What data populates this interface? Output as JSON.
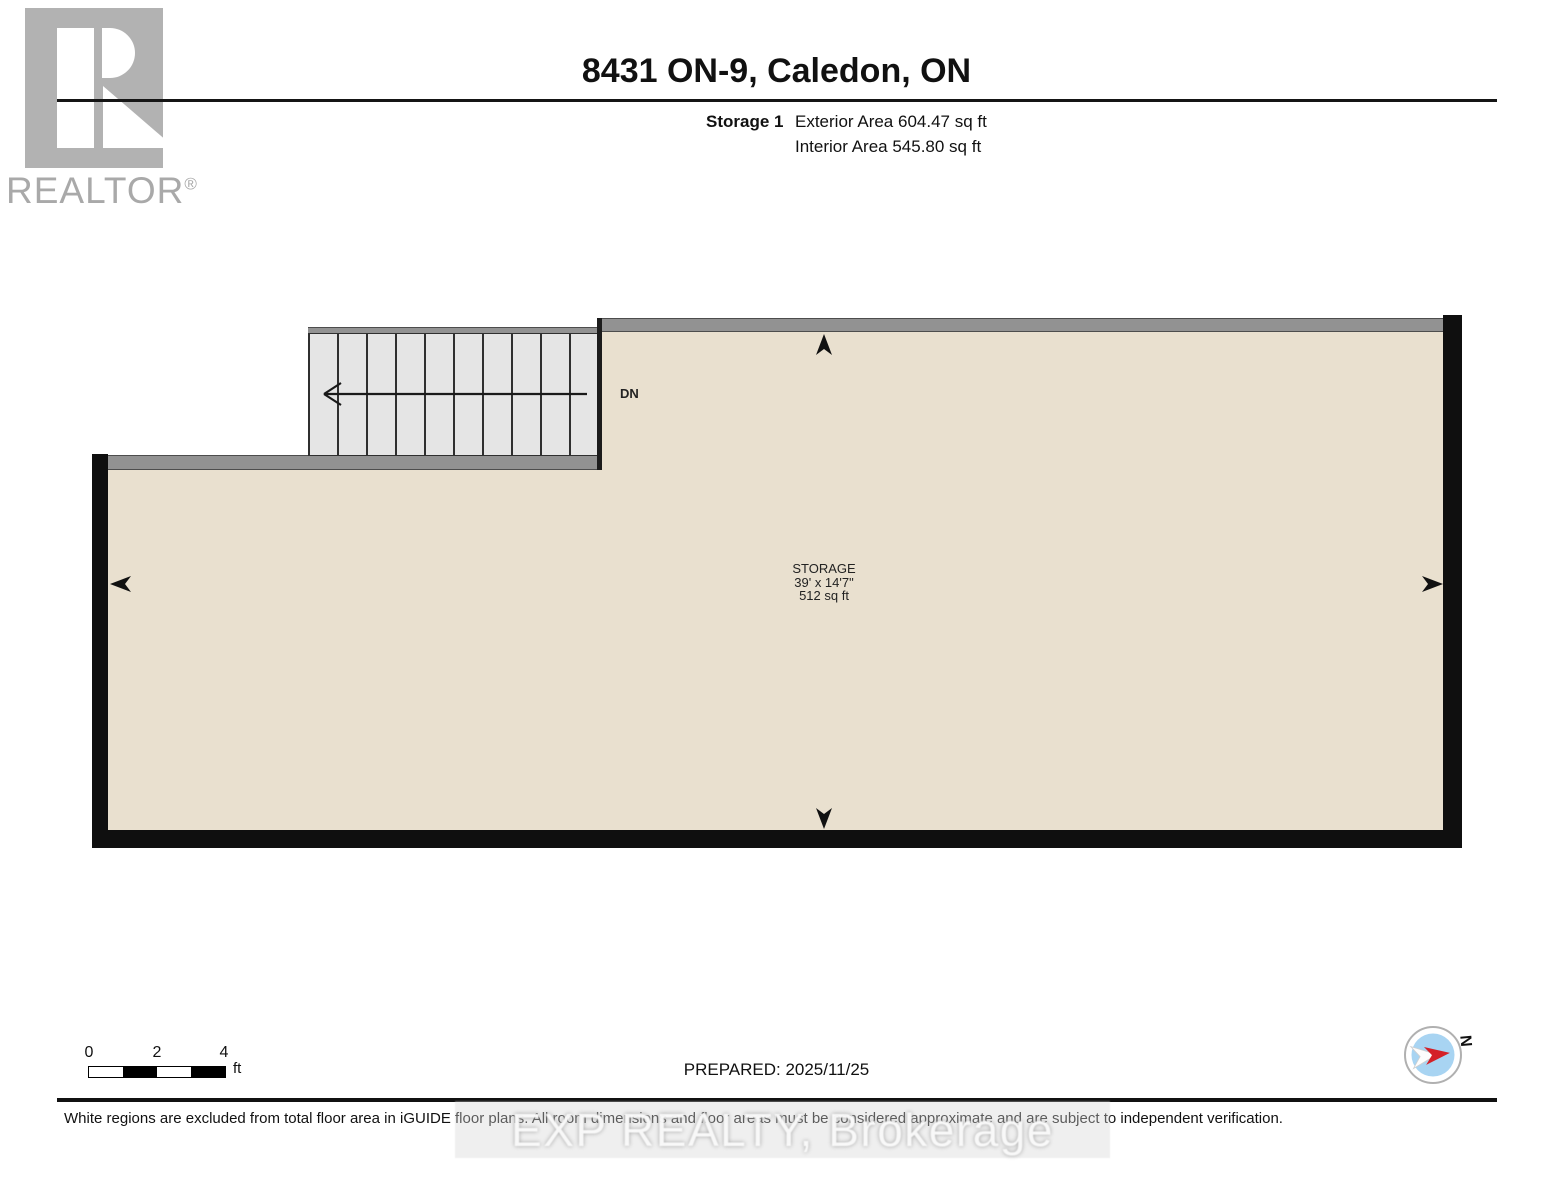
{
  "header": {
    "logo_text": "REALTOR",
    "logo_reg": "®",
    "title": "8431 ON-9, Caledon, ON",
    "floor_label": "Storage 1",
    "exterior_area": "Exterior Area 604.47 sq ft",
    "interior_area": "Interior Area 545.80 sq ft"
  },
  "plan": {
    "room": {
      "name": "STORAGE",
      "dimensions": "39' x 14'7\"",
      "area": "512 sq ft"
    },
    "stairs_label": "DN",
    "colors": {
      "floor_fill": "#e9e0cf",
      "wall_gray": "#929292",
      "wall_black": "#0f0f0f",
      "stair_fill": "#e5e5e5",
      "compass_blue": "#a8d4f2",
      "compass_red": "#d42027",
      "logo_gray": "#b2b2b2"
    }
  },
  "footer": {
    "scale": {
      "ticks": [
        "0",
        "2",
        "4"
      ],
      "unit": "ft"
    },
    "prepared": "PREPARED: 2025/11/25",
    "compass_label": "N",
    "disclaimer": "White regions are excluded from total floor area in iGUIDE floor plans. All room dimensions and floor areas must be considered approximate and are subject to independent verification.",
    "watermark": "EXP REALTY, Brokerage"
  }
}
